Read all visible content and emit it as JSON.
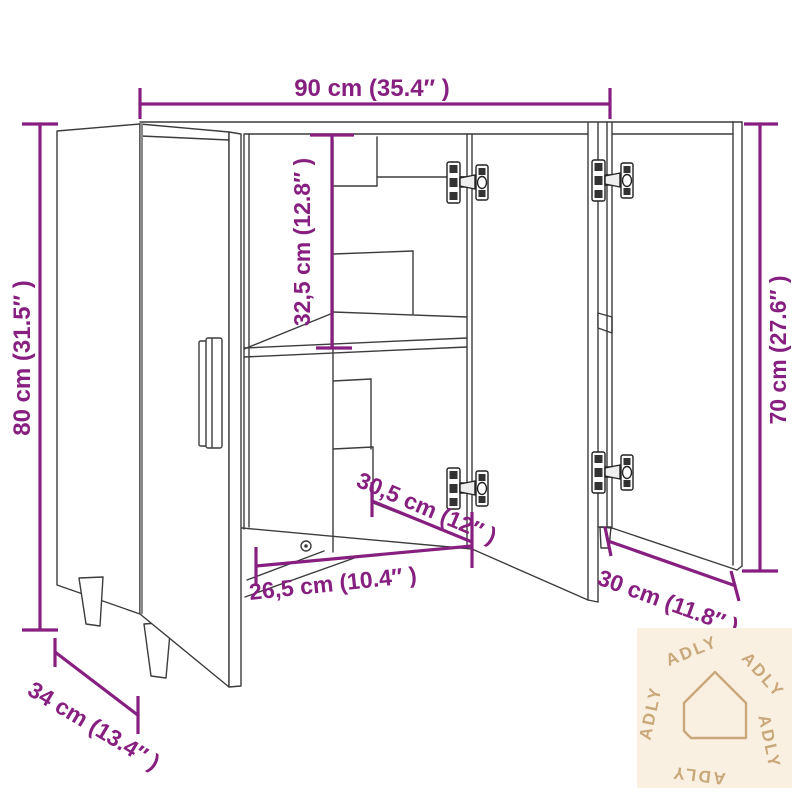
{
  "image": {
    "type": "furniture dimension diagram",
    "subject": "sideboard with open doors, interior shelf, concealed hinges and tapered wooden legs"
  },
  "colors": {
    "dimension": "#871f80",
    "drawing_line": "#3c3c3c",
    "background": "#ffffff",
    "watermark_bg": "#faf0e2",
    "watermark_fg": "#c8a87a"
  },
  "dimensions": {
    "overall_width": {
      "label": "90 cm (35.4″ )"
    },
    "overall_height": {
      "label": "80 cm (31.5″ )"
    },
    "upper_compartment_height": {
      "label": "32,5 cm (12.8″ )"
    },
    "interior_depth": {
      "label": "30,5 cm (12″ )"
    },
    "compartment_width": {
      "label": "26,5 cm (10.4″ )"
    },
    "right_door_width": {
      "label": "30 cm (11.8″ )"
    },
    "side_height": {
      "label": "70 cm (27.6″ )"
    },
    "overall_depth": {
      "label": "34 cm (13.4″ )"
    }
  },
  "watermark": {
    "brand": "ADLY"
  }
}
